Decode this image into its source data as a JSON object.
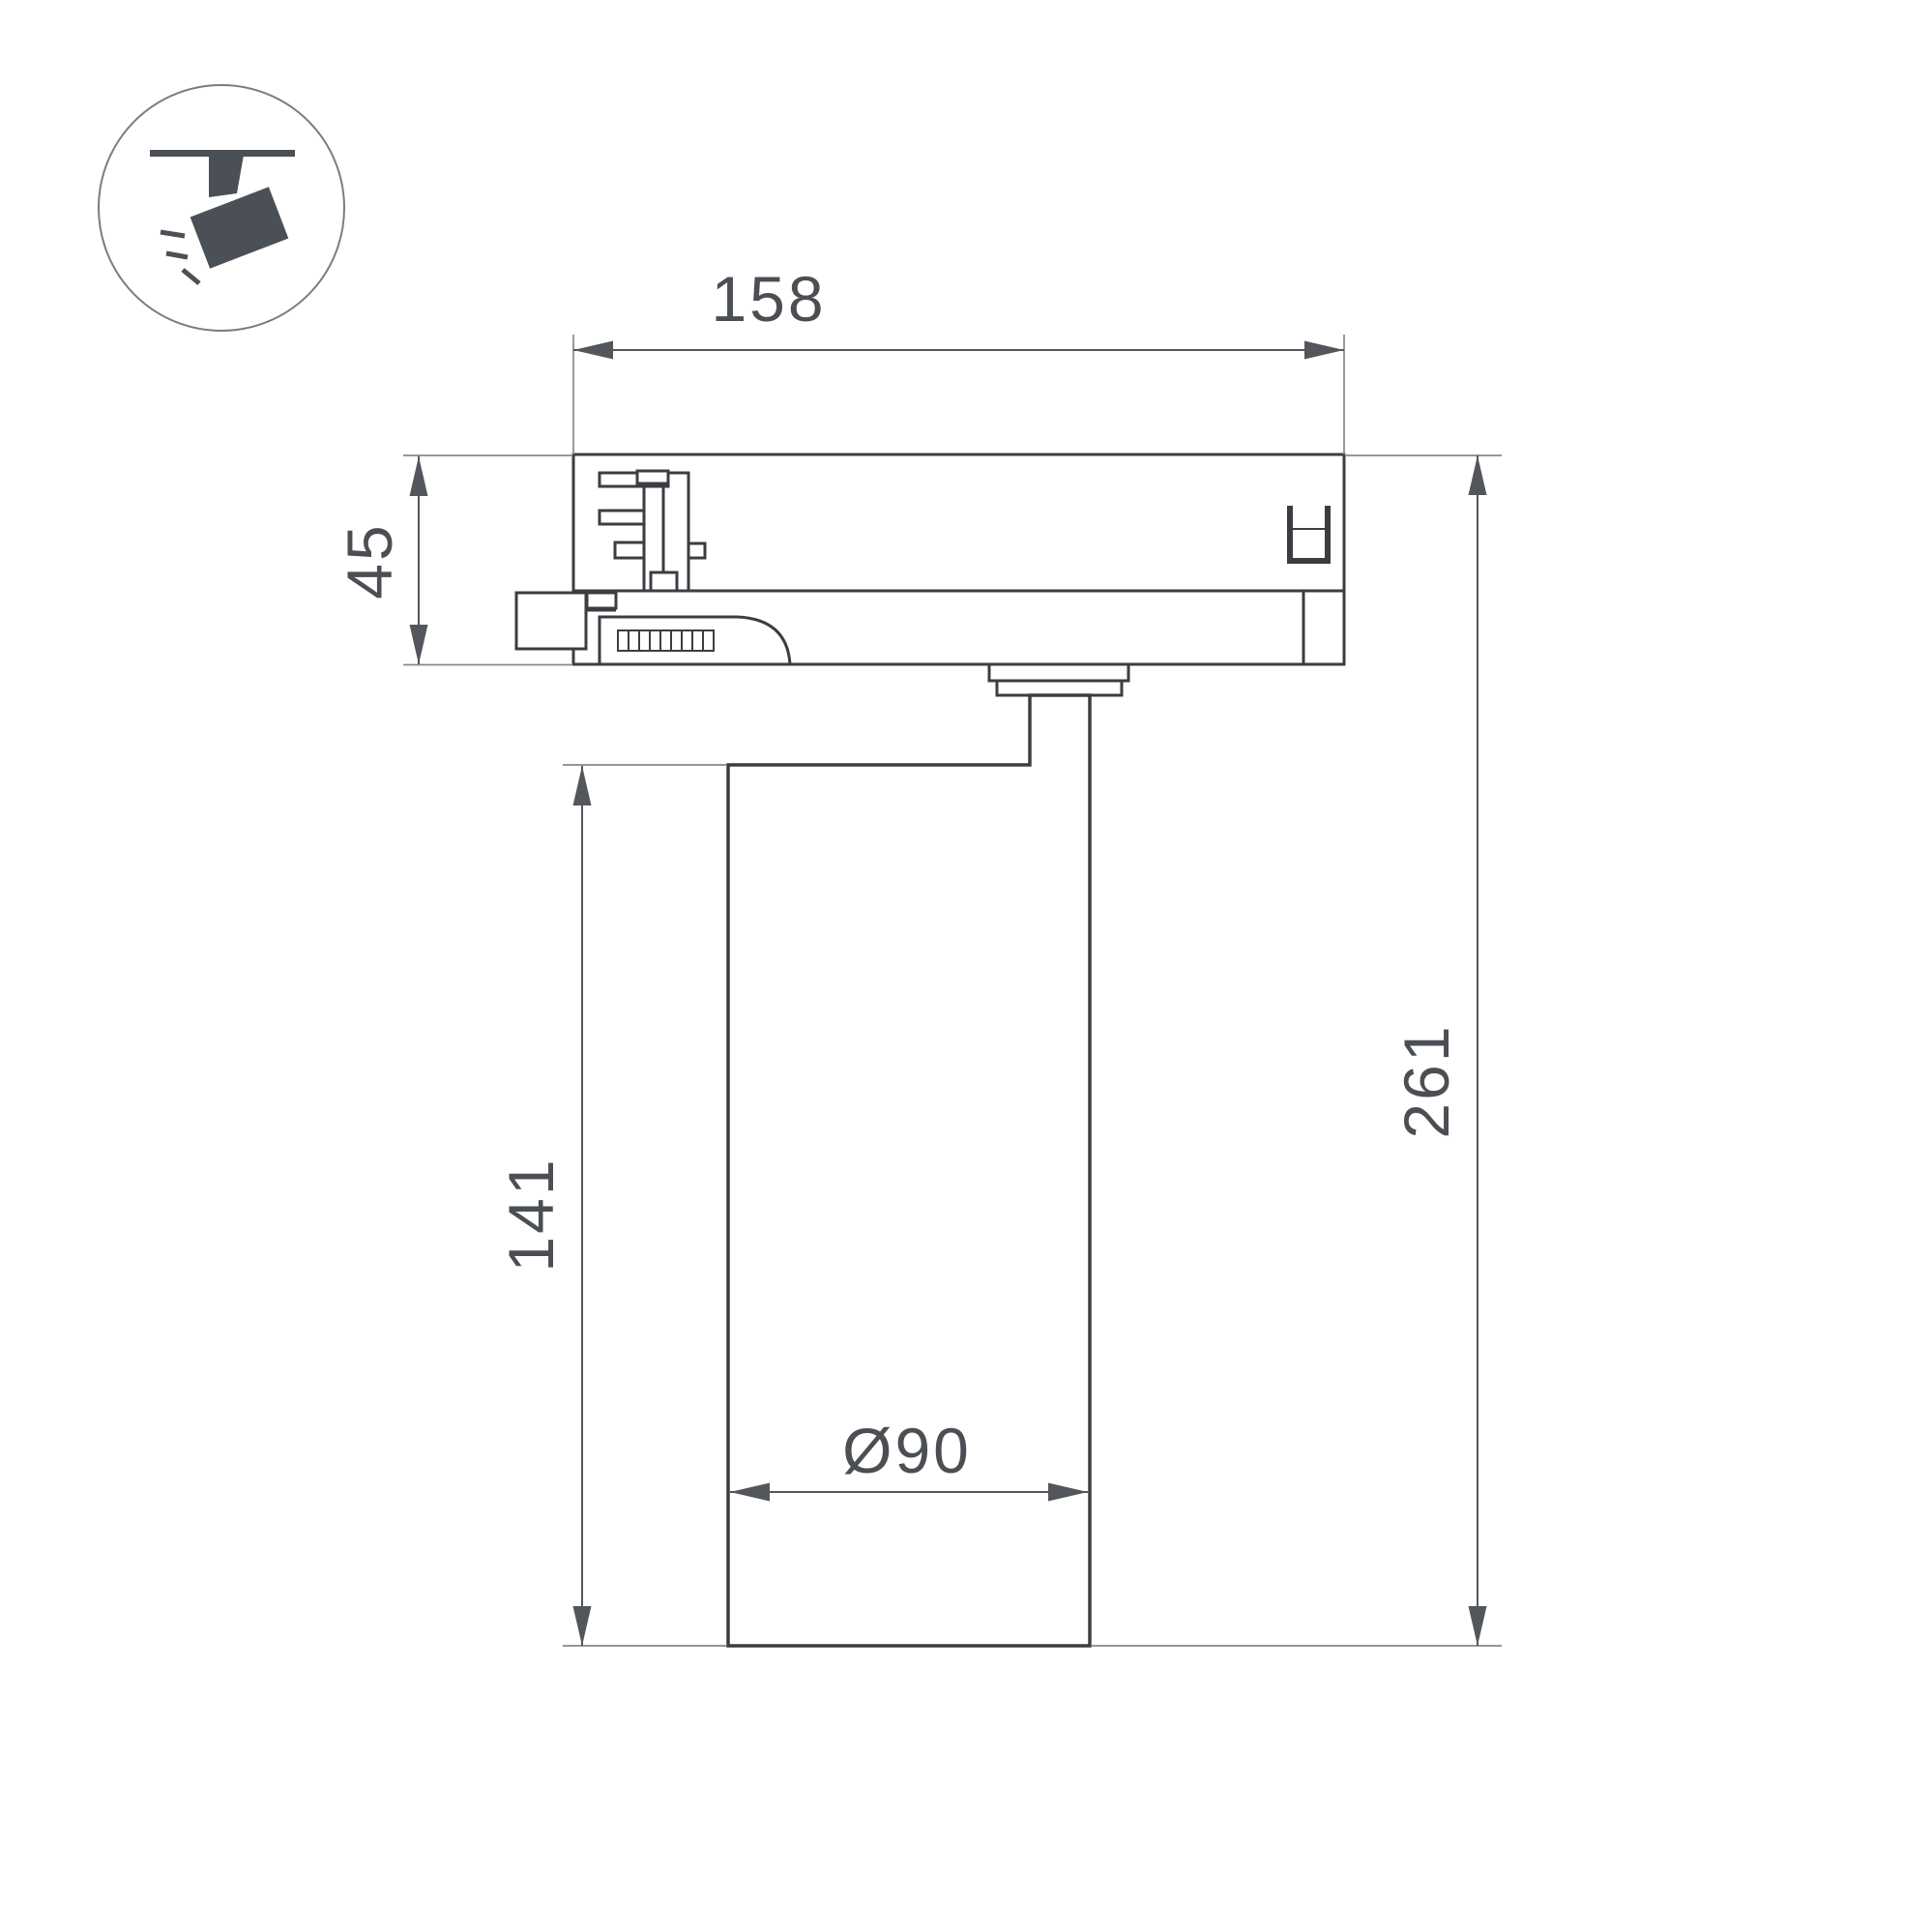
{
  "dimensions": {
    "adapter_width": "158",
    "adapter_height": "45",
    "body_height": "141",
    "total_height": "261",
    "body_diameter": "Ø90"
  },
  "icons": {
    "badge": "track-spotlight-icon"
  },
  "colors": {
    "background": "#ffffff",
    "outline": "#3a3e42",
    "dimension": "#53575c",
    "extension": "#85888b",
    "text": "#4b4f54",
    "icon": "#4a5056",
    "icon_ring": "#7a7d80"
  }
}
